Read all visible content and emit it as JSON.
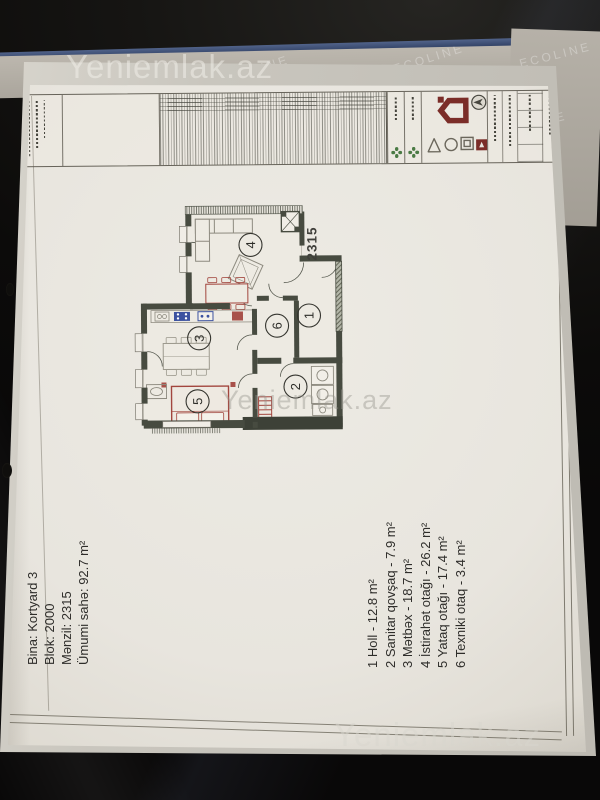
{
  "watermark": {
    "text": "Yeniemlak.az"
  },
  "cover": {
    "brand": "ECOLINE"
  },
  "info_block": {
    "lines": [
      "Bina: Kortyard 3",
      "Blok: 2000",
      "Mənzil: 2315",
      "Ümumi sahə: 92.7 m²"
    ]
  },
  "legend": {
    "items": [
      "1 Holl - 12.8 m²",
      "2 Sanitar qovşaq - 7.9 m²",
      "3 Mətbəx - 18.7 m²",
      "4 İstirahət otağı - 26.2 m²",
      "5 Yataq otağı - 17.4 m²",
      "6 Texniki otaq - 3.4 m²"
    ]
  },
  "plan": {
    "number": "2315",
    "rooms": [
      "1",
      "2",
      "3",
      "4",
      "5",
      "6"
    ],
    "colors": {
      "wall": "#474b40",
      "furniture_red": "#a2463e",
      "appliance_blue": "#3c52a0",
      "logo_red": "#7b2d28",
      "logo_green": "#4a7a44",
      "binder_blue": "#2c3c5f",
      "paper": "#e8e5de"
    }
  }
}
